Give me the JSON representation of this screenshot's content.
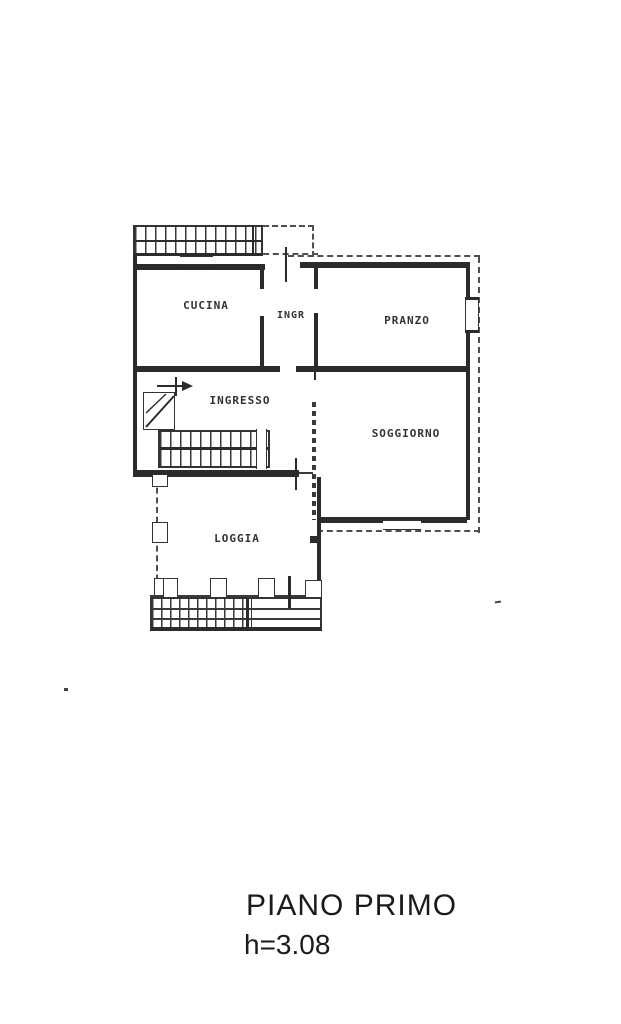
{
  "floor_plan": {
    "rooms": [
      {
        "name": "cucina",
        "label": "CUCINA"
      },
      {
        "name": "ingr",
        "label": "INGR"
      },
      {
        "name": "pranzo",
        "label": "PRANZO"
      },
      {
        "name": "ingresso",
        "label": "INGRESSO"
      },
      {
        "name": "soggiorno",
        "label": "SOGGIORNO"
      },
      {
        "name": "loggia",
        "label": "LOGGIA"
      }
    ],
    "glyphs": {
      "balcony_railing": "hatched-strip",
      "staircase": "hatched-strip-with-arrow",
      "window": "double-line-box",
      "door_mark": "short-tick-line"
    },
    "colors": {
      "ink": "#2b2b2b",
      "paper": "#ffffff"
    }
  },
  "caption": {
    "title": "PIANO PRIMO",
    "height_label": "h=3.08"
  }
}
